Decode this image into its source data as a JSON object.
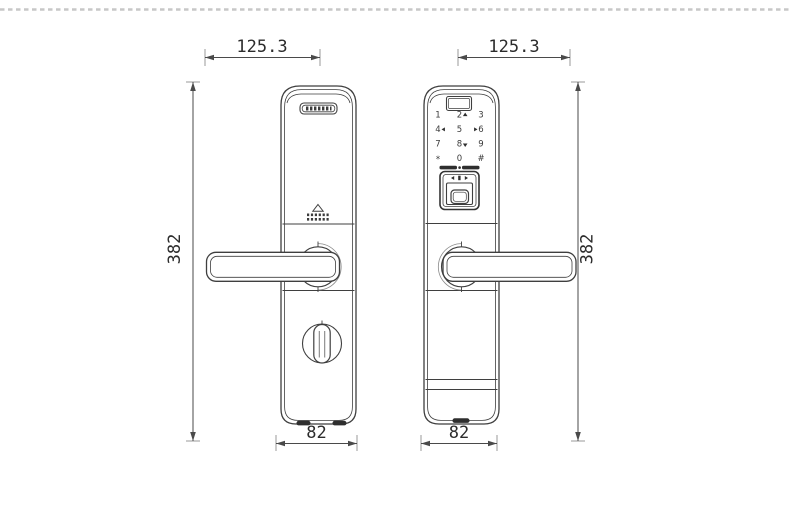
{
  "page": {
    "background_color": "#ffffff",
    "divider_color": "#c7c7c7",
    "line_color": "#3f3f3f",
    "dim_color": "#4a4a4a",
    "dark_fill": "#2e2e2e"
  },
  "views": {
    "back": {
      "dim_width_label": "125.3",
      "dim_height_label": "382",
      "dim_bottom_width_label": "82"
    },
    "front": {
      "dim_width_label": "125.3",
      "dim_height_label": "382",
      "dim_bottom_width_label": "82"
    }
  },
  "keypad": {
    "keys": [
      "1",
      "2",
      "3",
      "4",
      "5",
      "6",
      "7",
      "8",
      "9",
      "*",
      "0",
      "#"
    ]
  },
  "icons": {
    "brand_plate": "brand-logo-plate",
    "speaker": "speaker-grille-icon",
    "thumbturn": "thumbturn-knob-icon",
    "display": "display-window",
    "fingerprint": "fingerprint-scanner-icon",
    "nav_marks": [
      "up",
      "left",
      "right",
      "down"
    ]
  }
}
